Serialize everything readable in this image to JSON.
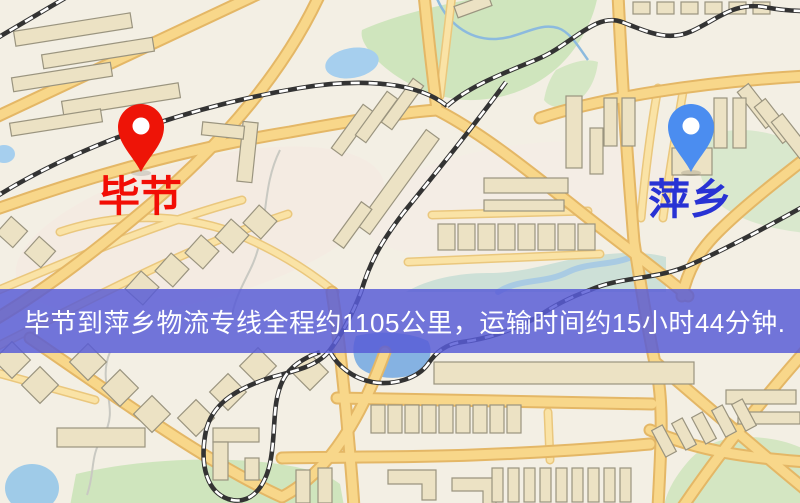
{
  "page": {
    "type": "road-map-screenshot"
  },
  "map": {
    "markers": [
      {
        "id": "origin",
        "label": "毕节",
        "pin_color": "#ee1407",
        "label_color": "#f20d05",
        "icon": "map-pin-icon"
      },
      {
        "id": "destination",
        "label": "萍乡",
        "pin_color": "#4b8df0",
        "label_color": "#2832d4",
        "icon": "map-pin-icon"
      }
    ],
    "banner": {
      "text": "毕节到萍乡物流专线全程约1105公里，运输时间约15小时44分钟.",
      "background_color": "#585cd6",
      "text_color": "#ffffff"
    },
    "route": {
      "origin": "毕节",
      "destination": "萍乡",
      "distance_text": "约1105公里",
      "duration_text": "约15小时44分钟",
      "distance_km": 1105,
      "duration_hours": 15,
      "duration_minutes": 44
    },
    "palette": {
      "map_background": "#f3efe4",
      "road_fill": "#f8d78a",
      "road_casing": "#e4b766",
      "water": "#a6cfee",
      "park_green": "#cfe5bd",
      "railway": "#333333",
      "building": "#ece2c4"
    }
  }
}
